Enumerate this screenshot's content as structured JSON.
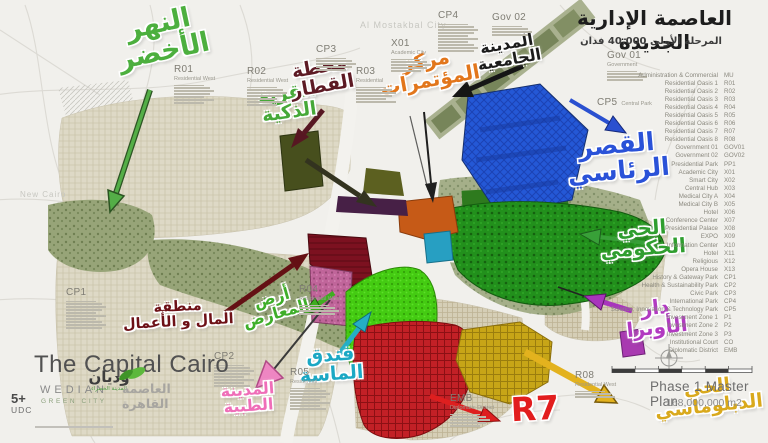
{
  "title_block": {
    "title": "العاصمة الإدارية الجديدة",
    "subtitle": "المرحلة الأولى 40,000 فدان"
  },
  "watermarks": {
    "new_cairo": "New Cairo",
    "mostakbal": "Al Mostakbal City"
  },
  "callouts": {
    "green_river": {
      "line1": "النهر",
      "line2": "الأخضر",
      "color": "#4caf3e"
    },
    "smart_village": {
      "line1": "القرية",
      "line2": "الذكية",
      "color": "#46a838"
    },
    "train_station": {
      "line1": "محطة",
      "line2": "القطار",
      "color": "#5d1a24"
    },
    "conference_center": {
      "line1": "مركز",
      "line2": "المؤتمرات",
      "color": "#e2761b"
    },
    "university_city": {
      "line1": "المدينة",
      "line2": "الجامعية",
      "color": "#1c1c1c"
    },
    "presidential_palace": {
      "line1": "القصر",
      "line2": "الرئاسي",
      "color": "#2a52d8"
    },
    "government_district": {
      "line1": "الحي",
      "line2": "الحكومي",
      "color": "#2f9e2f"
    },
    "opera_house": {
      "line1": "دار",
      "line2": "الأوبرا",
      "color": "#b13ac1"
    },
    "financial_district": {
      "line1": "منطقة",
      "line2": "المال و الأعمال",
      "color": "#6d1016"
    },
    "expo_grounds": {
      "line1": "أرض",
      "line2": "المعارض",
      "color": "#3fae2a"
    },
    "almasa_hotel": {
      "line1": "فندق",
      "line2": "الماسة",
      "color": "#1ba8c4"
    },
    "medical_city": {
      "line1": "المدينة",
      "line2": "الطبية",
      "color": "#ef6eb8"
    },
    "diplomatic_district": {
      "line1": "الحي",
      "line2": "الدبلوماسي",
      "color": "#d9a91c"
    },
    "r7": {
      "text": "R7",
      "color": "#e21d1d"
    }
  },
  "zone_labels": {
    "r01": {
      "code": "R01",
      "sub": "Residential West"
    },
    "r02": {
      "code": "R02",
      "sub": "Residential West"
    },
    "r03": {
      "code": "R03",
      "sub": "Residential"
    },
    "cp3": {
      "code": "CP3",
      "sub": ""
    },
    "x01": {
      "code": "X01",
      "sub": "Academic City"
    },
    "cp4": {
      "code": "CP4",
      "sub": ""
    },
    "gov02": {
      "code": "Gov 02",
      "sub": ""
    },
    "gov01": {
      "code": "Gov 01",
      "sub": "Government"
    },
    "cp5": {
      "code": "CP5",
      "sub": "Central Park"
    },
    "cp1": {
      "code": "CP1",
      "sub": ""
    },
    "r04": {
      "code": "R04",
      "sub": "Residential West"
    },
    "cp2": {
      "code": "CP2",
      "sub": ""
    },
    "r05": {
      "code": "R05",
      "sub": "Residential"
    },
    "r08": {
      "code": "R08",
      "sub": "Residential West"
    },
    "emb": {
      "code": "EMB",
      "sub": "Diplomatic District"
    }
  },
  "legend": {
    "rows": [
      {
        "name": "Administration & Commercial",
        "code": "MU"
      },
      {
        "name": "Residential Oasis 1",
        "code": "R01"
      },
      {
        "name": "Residential Oasis 2",
        "code": "R02"
      },
      {
        "name": "Residential Oasis 3",
        "code": "R03"
      },
      {
        "name": "Residential Oasis 4",
        "code": "R04"
      },
      {
        "name": "Residential Oasis 5",
        "code": "R05"
      },
      {
        "name": "Residential Oasis 6",
        "code": "R06"
      },
      {
        "name": "Residential Oasis 7",
        "code": "R07"
      },
      {
        "name": "Residential Oasis 8",
        "code": "R08"
      },
      {
        "name": "Government 01",
        "code": "GOV01"
      },
      {
        "name": "Government 02",
        "code": "GOV02"
      },
      {
        "name": "Presidential Park",
        "code": "PP1"
      },
      {
        "name": "Academic City",
        "code": "X01"
      },
      {
        "name": "Smart City",
        "code": "X02"
      },
      {
        "name": "Central Hub",
        "code": "X03"
      },
      {
        "name": "Medical City A",
        "code": "X04"
      },
      {
        "name": "Medical City B",
        "code": "X05"
      },
      {
        "name": "Hotel",
        "code": "X06"
      },
      {
        "name": "Conference Center",
        "code": "X07"
      },
      {
        "name": "Presidential Palace",
        "code": "X08"
      },
      {
        "name": "EXPO",
        "code": "X09"
      },
      {
        "name": "Information Center",
        "code": "X10"
      },
      {
        "name": "Hotel",
        "code": "X11"
      },
      {
        "name": "Religious",
        "code": "X12"
      },
      {
        "name": "Opera House",
        "code": "X13"
      },
      {
        "name": "History & Gateway Park",
        "code": "CP1"
      },
      {
        "name": "Health & Sustainability Park",
        "code": "CP2"
      },
      {
        "name": "Civic Park",
        "code": "CP3"
      },
      {
        "name": "International Park",
        "code": "CP4"
      },
      {
        "name": "Science, Innovation & Technology Park",
        "code": "CP5"
      },
      {
        "name": "Investment Zone 1",
        "code": "P1"
      },
      {
        "name": "Investment Zone 2",
        "code": "P2"
      },
      {
        "name": "Investment Zone 3",
        "code": "P3"
      },
      {
        "name": "Institutional Court",
        "code": "CO"
      },
      {
        "name": "Diplomatic District",
        "code": "EMB"
      }
    ]
  },
  "branding": {
    "title": "The Capital Cairo",
    "wedian": "WEDIAN",
    "green_city": "GREEN CITY",
    "logo_ar": "وديان",
    "logo_green_ar": "المدينة الخضراء",
    "capital_ar": "العاصمة القاهرة",
    "udc_number": "5+",
    "udc": "UDC"
  },
  "footer": {
    "plan": "Phase 1 Master Plan",
    "area": "168,000,000 m2"
  },
  "colors": {
    "palace_blue": "#2458d6",
    "government_green": "#22901c",
    "expo_lime": "#44cb12",
    "r7_red": "#c22026",
    "diplomatic_yellow": "#c7a517",
    "medical_pink": "#c0659a",
    "financial_darkred": "#7c1120",
    "hotel_teal": "#279fc2",
    "conference_orange": "#c65a17"
  }
}
